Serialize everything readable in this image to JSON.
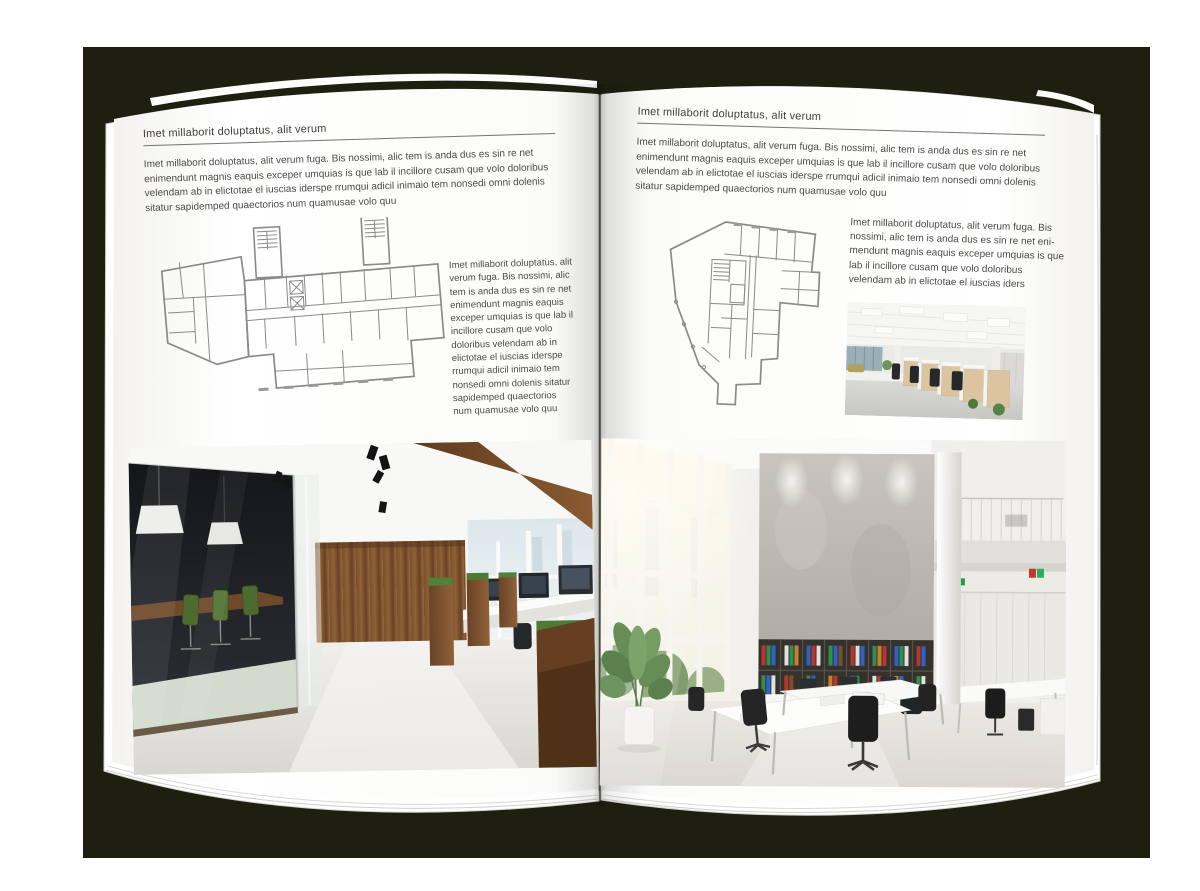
{
  "page_left": {
    "header": "Imet millaborit doluptatus, alit verum",
    "intro": "Imet millaborit doluptatus, alit verum fuga. Bis nossimi, alic tem is anda dus es sin re net enimendunt magnis eaquis exceper umquias is que lab il incillore cusam que volo doloribus velendam ab in elictotae el iuscias iderspe rrumqui adicil inimaio tem nonsedi omni dolenis sitatur sapidemped quaectorios num quamusae volo quu",
    "side_text": "Imet millaborit doluptatus, alit verum fuga. Bis nossimi, alic tem is anda dus es sin re net enimendunt magnis eaquis exceper umquias is que lab il incillore cusam que volo doloribus velendam ab in elictotae el iuscias iderspe rrumqui adicil inimaio tem nonsedi omni dolenis sitatur sapidemped quaectorios num quamusae volo quu"
  },
  "page_right": {
    "header": "Imet millaborit doluptatus, alit verum",
    "intro": "Imet millaborit doluptatus, alit verum fuga. Bis nossimi, alic tem is anda dus es sin re net enimendunt magnis eaquis exceper umquias is que lab il incillore cusam que volo doloribus velendam ab in elictotae el iuscias iderspe rrumqui adicil inimaio tem nonsedi omni dolenis sitatur sapidemped quaectorios num quamusae volo quu",
    "side_text": "Imet millaborit doluptatus, alit verum fuga. Bis nossimi, alic tem is anda dus es sin re net eni-mendunt magnis eaquis exceper umquias is que lab il incillore cusam que volo doloribus velendam ab in elictotae el iuscias iders"
  },
  "colors": {
    "backdrop": "#1e1f0e",
    "page": "#ffffff",
    "body_text": "#4b4a45",
    "plan_lines": "#8a8a8a",
    "wood": "#7c4f2b",
    "chair_green": "#4e6c30",
    "binder_red": "#b5382e",
    "binder_green": "#2f8f4f",
    "binder_blue": "#3061c6"
  }
}
